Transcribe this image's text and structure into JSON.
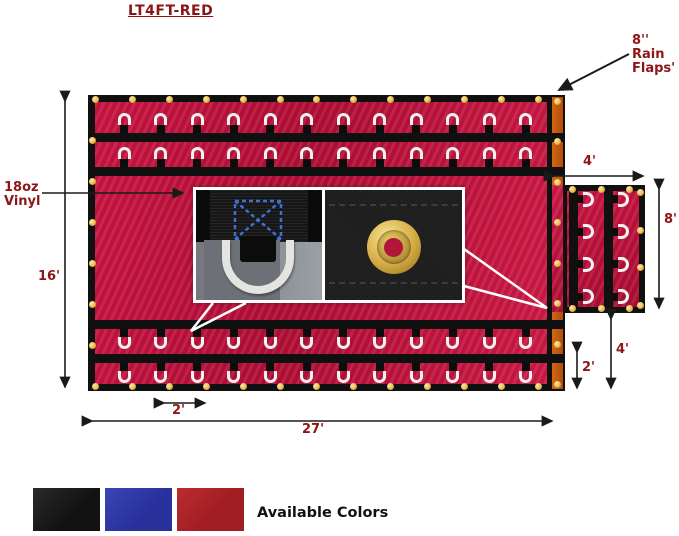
{
  "title": "LT4FT-RED",
  "callouts": {
    "rain_flaps": [
      "8''",
      "Rain",
      "Flaps'"
    ],
    "material": [
      "18oz",
      "Vinyl"
    ]
  },
  "dimensions": {
    "side_height": "16'",
    "overall_width": "27'",
    "ring_spacing": "2'",
    "end_flap_width": "4'",
    "end_flap_height": "8'",
    "rear_drop": "4'",
    "rear_small_drop": "2'"
  },
  "footer": {
    "available_colors_label": "Available Colors"
  },
  "swatches": [
    {
      "name": "black",
      "hex": "#171717"
    },
    {
      "name": "blue",
      "hex": "#2c35a3"
    },
    {
      "name": "red",
      "hex": "#b02127"
    }
  ],
  "colors": {
    "tarp_red": "#c41239",
    "strap_black": "#101010",
    "rain_flap_orange": "#c4590f",
    "grommet_gold": "#f0c566",
    "dring_silver": "#f2f2f0",
    "label_dark_red": "#8e1616",
    "stitch_blue": "#3f6fd0"
  },
  "hardware": {
    "top_grommets": 13,
    "bottom_grommets": 13,
    "left_grommets": 6,
    "strip_grommets": 8,
    "junction_grommets": 4,
    "rings_per_row": 12,
    "flap_rings_per_strap": 4,
    "flap_top_grommets": 3,
    "flap_bottom_grommets": 3,
    "flap_right_grommets": 4
  }
}
